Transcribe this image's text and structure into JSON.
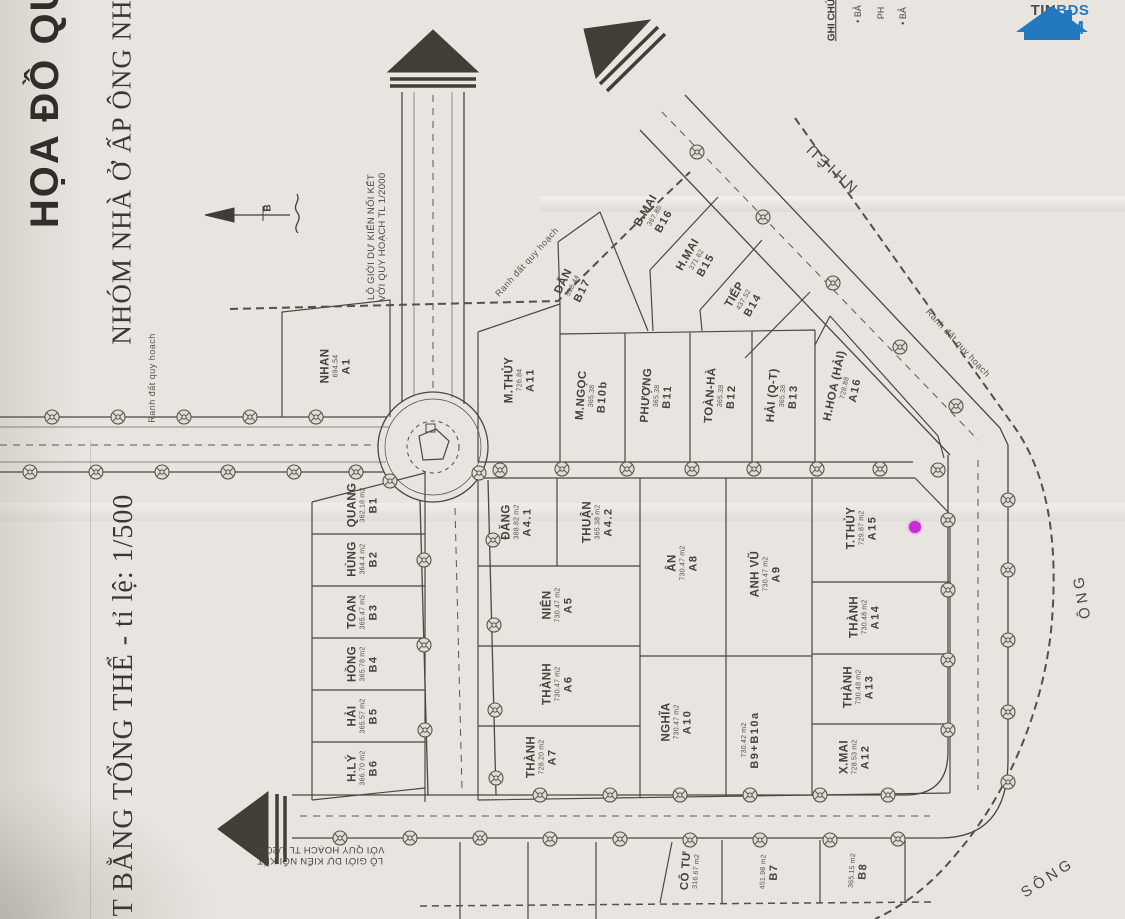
{
  "titles": {
    "main": "HỌA ĐỒ QUY",
    "sub": "NHÓM NHÀ Ở ẤP ÔNG NH",
    "scale": "T BẰNG TỔNG THỂ - tỉ lệ: 1/500"
  },
  "legend": {
    "header": "GHI CHÚ",
    "items": [
      "• BẢ",
      "PH",
      "• BẢ"
    ]
  },
  "road_note": {
    "line1": "LỘ GIỚI DỰ KIẾN NỐI KẾT",
    "line2": "VỚI QUY HOẠCH TL 1/2000"
  },
  "boundary_label": "Ranh đất quy hoạch",
  "compass_label": "B",
  "river": {
    "part_top": "NHIÊU",
    "part_mid": "ÔNG",
    "part_bottom": "SÔNG"
  },
  "logo": {
    "tin": "TIN",
    "bds": "BDS",
    "c": "C",
    "o": "O",
    "m": "M"
  },
  "marker_color": "#c62bd4",
  "plots": [
    {
      "id": "A1",
      "name": "NHAN",
      "area": "694.54",
      "code": "A1"
    },
    {
      "id": "A11",
      "name": "M.THỦY",
      "area": "726.84",
      "code": "A11"
    },
    {
      "id": "B17",
      "name": "DẪN",
      "area": "598.44",
      "code": "B17"
    },
    {
      "id": "B16",
      "name": "B.MAI",
      "area": "367.85",
      "code": "B16"
    },
    {
      "id": "B15",
      "name": "H.MAI",
      "area": "371.62",
      "code": "B15"
    },
    {
      "id": "B14",
      "name": "TIẾP",
      "area": "437.52",
      "code": "B14"
    },
    {
      "id": "B10b",
      "name": "M.NGỌC",
      "area": "365.38",
      "code": "B10b"
    },
    {
      "id": "B11",
      "name": "PHƯỢNG",
      "area": "365.38",
      "code": "B11"
    },
    {
      "id": "B12",
      "name": "TOÀN-HÀ",
      "area": "365.38",
      "code": "B12"
    },
    {
      "id": "B13",
      "name": "HẢI (Q-T)",
      "area": "365.38",
      "code": "B13"
    },
    {
      "id": "A16",
      "name": "H.HOA (HẢI)",
      "area": "728.88",
      "code": "A16"
    },
    {
      "id": "B1",
      "name": "QUANG",
      "area": "362.18 m2",
      "code": "B1"
    },
    {
      "id": "B2",
      "name": "HÙNG",
      "area": "364.4 m2",
      "code": "B2"
    },
    {
      "id": "B3",
      "name": "TOAN",
      "area": "365.47 m2",
      "code": "B3"
    },
    {
      "id": "B4",
      "name": "HỒNG",
      "area": "365.78 m2",
      "code": "B4"
    },
    {
      "id": "B5",
      "name": "HẢI",
      "area": "365.57 m2",
      "code": "B5"
    },
    {
      "id": "B6",
      "name": "H.LÝ",
      "area": "366.70 m2",
      "code": "B6"
    },
    {
      "id": "A4.1",
      "name": "ĐĂNG",
      "area": "388.82 m2",
      "code": "A4.1"
    },
    {
      "id": "A4.2",
      "name": "THUẬN",
      "area": "365.38 m2",
      "code": "A4.2"
    },
    {
      "id": "A5",
      "name": "NIÊN",
      "area": "730.47 m2",
      "code": "A5"
    },
    {
      "id": "A6",
      "name": "THÀNH",
      "area": "730.47 m2",
      "code": "A6"
    },
    {
      "id": "A7",
      "name": "THÀNH",
      "area": "728.20 m2",
      "code": "A7"
    },
    {
      "id": "A8",
      "name": "ÂN",
      "area": "730.47 m2",
      "code": "A8"
    },
    {
      "id": "A9",
      "name": "ANH VŨ",
      "area": "730.47 m2",
      "code": "A9"
    },
    {
      "id": "A10",
      "name": "NGHĨA",
      "area": "730.47 m2",
      "code": "A10"
    },
    {
      "id": "B9+B10a",
      "name": "",
      "area": "730.42 m2",
      "code": "B9+B10a"
    },
    {
      "id": "A15",
      "name": "T.THỦY",
      "area": "729.87 m2",
      "code": "A15"
    },
    {
      "id": "A14",
      "name": "THÀNH",
      "area": "730.48 m2",
      "code": "A14"
    },
    {
      "id": "A13",
      "name": "THÀNH",
      "area": "730.48 m2",
      "code": "A13"
    },
    {
      "id": "A12",
      "name": "X.MAI",
      "area": "728.53 m2",
      "code": "A12"
    },
    {
      "id": "COTU",
      "name": "CÔ TƯ",
      "area": "316.67 m2",
      "code": ""
    },
    {
      "id": "B7",
      "name": "",
      "area": "451.98 m2",
      "code": "B7"
    },
    {
      "id": "B8",
      "name": "",
      "area": "365.15 m2",
      "code": "B8"
    }
  ]
}
